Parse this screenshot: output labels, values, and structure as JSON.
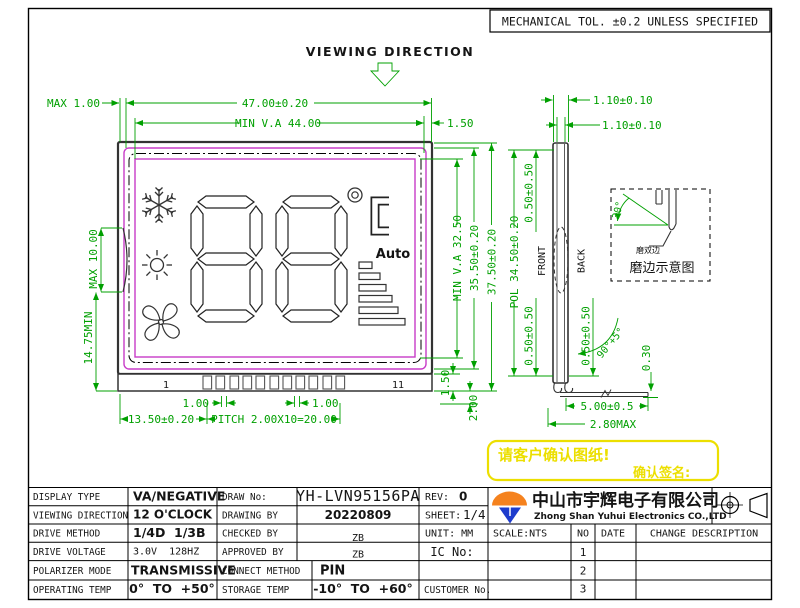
{
  "frame": {
    "tolerance_note": "MECHANICAL TOL. ±0.2 UNLESS SPECIFIED",
    "viewing_direction": "VIEWING DIRECTION"
  },
  "front_view": {
    "pin_first_label": "1",
    "pin_last_label": "11",
    "auto_label": "Auto",
    "dim_max_left": "MAX 1.00",
    "dim_width": "47.00±0.20",
    "dim_va_width": "MIN V.A 44.00",
    "dim_right_gap": "1.50",
    "dim_bump": "MAX 10.00",
    "dim_lower_left": "14.75MIN",
    "dim_va_height": "MIN V.A 32.50",
    "dim_height_inner": "35.50±0.20",
    "dim_height_total": "37.50±0.20",
    "dim_pol_height": "POL 34.50±0.20",
    "dim_pin_offset": "13.50±0.20",
    "dim_pitch": "PITCH 2.00X10=20.00",
    "dim_pin_a": "1.00",
    "dim_pin_b": "1.00",
    "dim_strip": "1.50",
    "dim_pin_len": "2.00"
  },
  "side_view": {
    "front_label": "FRONT",
    "back_label": "BACK",
    "dim_glass_t": "1.10±0.10",
    "dim_total_t": "1.10±0.10",
    "dim_pol_top": "0.50±0.50",
    "dim_pol_bottom": "0.50±0.50",
    "dim_lead_offset": "0.50±0.50",
    "dim_bend_angle": "90°+5°",
    "dim_lead_t": "0.30",
    "dim_foot_len": "5.00±0.5",
    "dim_foot_max": "2.80MAX"
  },
  "detail_box": {
    "dim_angle": "30°",
    "note": "磨双边",
    "caption": "磨边示意图"
  },
  "confirm_box": {
    "line1": "请客户确认图纸!",
    "line2": "确认签名:"
  },
  "title_block": {
    "display_type_label": "DISPLAY TYPE",
    "display_type": "VA/NEGATIVE",
    "viewing_direction_label": "VIEWING DIRECTION",
    "viewing_direction": "12 O'CLOCK",
    "drive_method_label": "DRIVE METHOD",
    "drive_method": "1/4D  1/3B",
    "drive_voltage_label": "DRIVE VOLTAGE",
    "drive_voltage": "3.0V  128HZ",
    "polarizer_mode_label": "POLARIZER MODE",
    "polarizer_mode": "TRANSMISSIVE",
    "operating_temp_label": "OPERATING TEMP",
    "operating_temp": "0°  TO  +50°",
    "draw_no_label": "DRAW No:",
    "draw_no": "YH-LVN95156PA",
    "drawing_by_label": "DRAWING BY",
    "drawing_by": "20220809",
    "checked_by_label": "CHECKED BY",
    "checked_by": "ZB",
    "approved_by_label": "APPROVED BY",
    "approved_by": "ZB",
    "connect_method_label": "CONNECT METHOD",
    "connect_method": "PIN",
    "storage_temp_label": "STORAGE TEMP",
    "storage_temp": "-10°  TO  +60°",
    "rev_label": "REV:",
    "rev": "0",
    "sheet_label": "SHEET:",
    "sheet": "1/4",
    "unit_label": "UNIT: MM",
    "scale_label": "SCALE:NTS",
    "ic_no_label": "IC No:",
    "customer_no_label": "CUSTOMER No."
  },
  "company": {
    "name_cn": "中山市宇辉电子有限公司",
    "name_en": "Zhong Shan Yuhui Electronics CO.,LTD"
  },
  "revision_table": {
    "no_header": "NO",
    "date_header": "DATE",
    "desc_header": "CHANGE DESCRIPTION",
    "rows": [
      {
        "no": "1"
      },
      {
        "no": "2"
      },
      {
        "no": "3"
      }
    ]
  },
  "colors": {
    "dimension_green": "#00a000",
    "polarizer_magenta": "#c83cc8",
    "highlight_yellow": "#ecdf00",
    "logo_orange": "#f5821e",
    "logo_blue": "#1e3ccd"
  }
}
